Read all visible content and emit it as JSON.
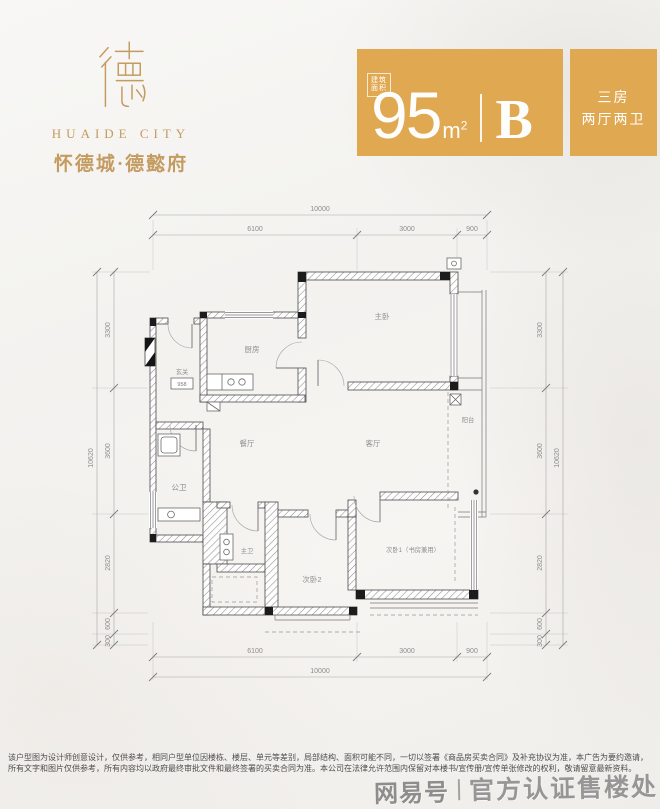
{
  "brand": {
    "name_en": "HUAIDE CITY",
    "name_cn": "怀德城·德懿府"
  },
  "badge": {
    "gold": "#E0A851",
    "area_label_line1": "建筑",
    "area_label_line2": "面积",
    "area_value": "95",
    "area_unit_m": "m",
    "area_unit_sup": "2",
    "unit_letter": "B",
    "rooms_line1": "三房",
    "rooms_line2": "两厅两卫"
  },
  "plan": {
    "rooms": {
      "foyer": "玄关",
      "kitchen": "厨房",
      "master": "主卧",
      "dining": "餐厅",
      "living": "客厅",
      "balcony": "阳台",
      "bath_left": "公卫",
      "bath_mid": "主卫",
      "bedroom2": "次卧2",
      "bedroom1": "次卧1（书房兼用）"
    },
    "entry_tag": "958",
    "dims": {
      "top_total": "10000",
      "seg_a": "6100",
      "seg_b": "3000",
      "seg_c": "900",
      "bottom_total": "10000",
      "v_a": "3300",
      "v_b": "3600",
      "v_c": "2820",
      "v_d": "600",
      "v_e": "300",
      "v_total": "10620"
    }
  },
  "disclaimer": "该户型图为设计师创意设计，仅供参考，相同户型单位因楼栋、楼层、单元等差别，局部结构、面积可能不同，一切以签署《商品房买卖合同》及补充协议为准，本广告为要约邀请，所有文字和图片仅供参考，所有内容均以政府最终审批文件和最终签署的买卖合同为准。本公司在法律允许范围内保留对本楼书/宣传册/宣传单张修改的权利，敬请留意最新资料。",
  "watermark": {
    "source": "网易号",
    "text": "官方认证售楼处"
  }
}
